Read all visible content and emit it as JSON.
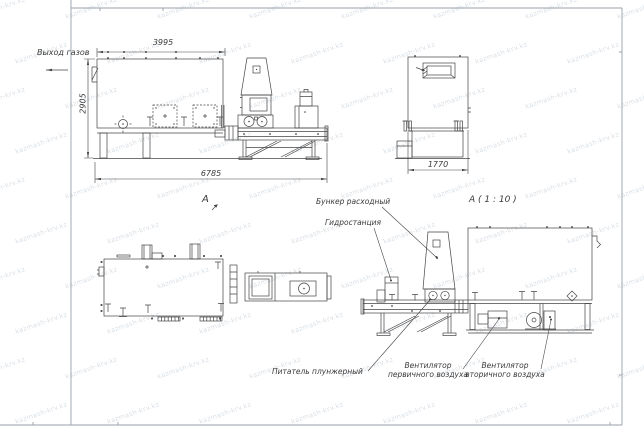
{
  "drawing": {
    "labels": {
      "gas_outlet": "Выход газов",
      "view_a_marker": "А",
      "detail_view_title": "А ( 1 : 10 )",
      "feed_hopper": "Бункер расходный",
      "hydraulic_station": "Гидростанция",
      "plunger_feeder": "Питатель плунжерный",
      "primary_air_fan_line1": "Вентилятор",
      "primary_air_fan_line2": "первичного воздуха",
      "secondary_air_fan_line1": "Вентилятор",
      "secondary_air_fan_line2": "вторичного воздуха"
    },
    "dimensions": {
      "top_length": "3995",
      "left_height": "2905",
      "overall_length": "6785",
      "front_width": "1770"
    },
    "watermark_text": "kazmash-krv.kz",
    "colors": {
      "line": "#444444",
      "text": "#3b3b3b",
      "frame": "#99a1a9",
      "watermark": "#9caab9",
      "background": "#ffffff"
    }
  }
}
